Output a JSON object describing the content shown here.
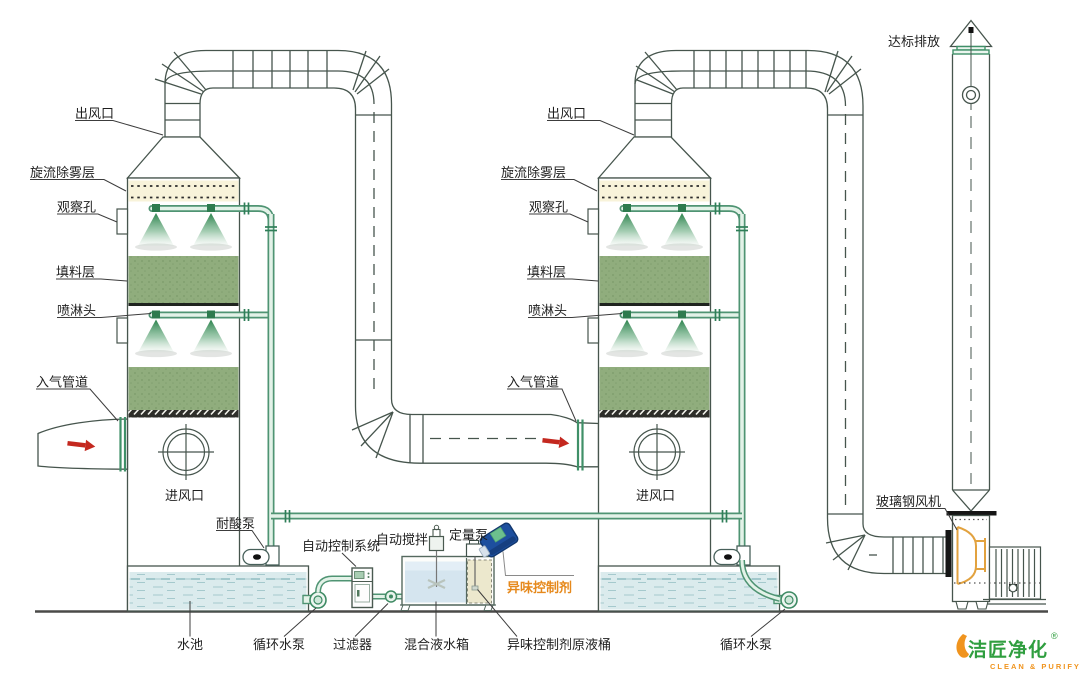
{
  "diagram_title": "喷淋塔废气处理系统示意图",
  "labels": {
    "tower1": {
      "outlet": "出风口",
      "demister": "旋流除雾层",
      "sight_glass": "观察孔",
      "packing": "填料层",
      "spray_head": "喷淋头",
      "gas_inlet": "入气管道",
      "air_inlet": "进风口",
      "acid_pump": "耐酸泵"
    },
    "tower2": {
      "outlet": "出风口",
      "demister": "旋流除雾层",
      "sight_glass": "观察孔",
      "packing": "填料层",
      "spray_head": "喷淋头",
      "gas_inlet": "入气管道",
      "air_inlet": "进风口"
    },
    "ground": {
      "pool": "水池",
      "circulating_pump_left": "循环水泵",
      "filter": "过滤器",
      "mixing_tank": "混合液水箱",
      "agent_stock_drum": "异味控制剂原液桶",
      "circulating_pump_right": "循环水泵"
    },
    "dosing": {
      "control_system": "自动控制系统",
      "auto_stirrer": "自动搅拌",
      "metering_pump": "定量泵",
      "odor_agent": "异味控制剂"
    },
    "exhaust": {
      "discharge": "达标排放",
      "fan": "玻璃钢风机"
    }
  },
  "logo": {
    "name": "洁匠净化",
    "reg": "®",
    "tagline": "CLEAN & PURIFY"
  },
  "colors": {
    "pipe_green": "#4f9473",
    "pipe_fill": "#e3f2e8",
    "flange_green": "#3f9068",
    "packing_green": "#90ad7d",
    "demister_beige": "#f8f3da",
    "water_blue": "#dbebed",
    "tank_water": "#d5e5ef",
    "stock_beige": "#ece8cd",
    "barrel_blue": "#1d4f9e",
    "alert_red": "#c4281f",
    "accent_orange": "#e6891c",
    "fan_orange": "#e2a23f",
    "logo_green": "#2f9e3f",
    "logo_orange": "#f0941e",
    "line_dark": "#46554d"
  }
}
